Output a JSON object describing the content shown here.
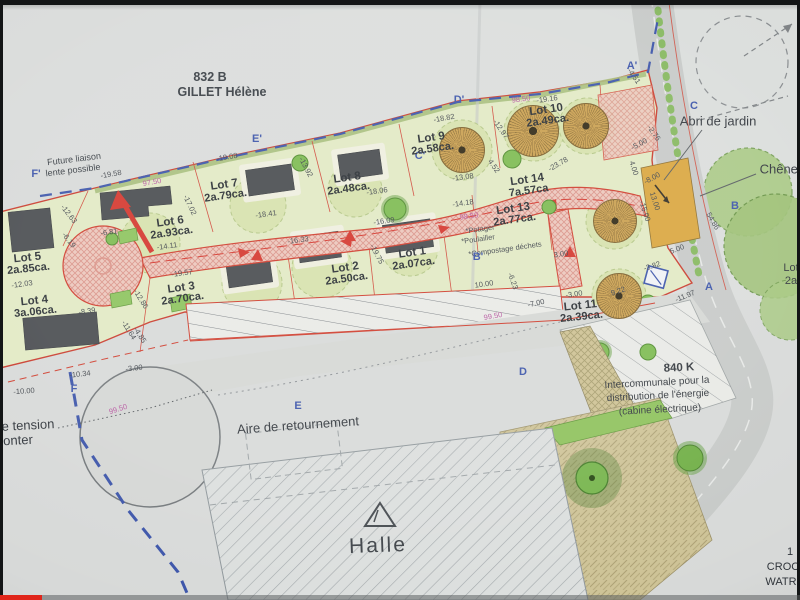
{
  "colors": {
    "accent_red": "#cf3b2b",
    "boundary_blue": "#3952a8",
    "dim_pink": "#b6569f",
    "dim_gray": "#41464c",
    "progress_red": "#e0251a"
  },
  "player": {
    "progress_played_px": 42
  },
  "plan": {
    "lots": [
      {
        "name": "Lot 1",
        "area": "2a.07ca.",
        "x": 413,
        "y": 259,
        "r": -8
      },
      {
        "name": "Lot 2",
        "area": "2a.50ca.",
        "x": 346,
        "y": 274,
        "r": -8
      },
      {
        "name": "Lot 3",
        "area": "2a.70ca.",
        "x": 182,
        "y": 294,
        "r": -8
      },
      {
        "name": "Lot 4",
        "area": "3a.06ca.",
        "x": 35,
        "y": 307,
        "r": -6
      },
      {
        "name": "Lot 5",
        "area": "2a.85ca.",
        "x": 28,
        "y": 264,
        "r": -6
      },
      {
        "name": "Lot 6",
        "area": "2a.93ca.",
        "x": 171,
        "y": 228,
        "r": -8
      },
      {
        "name": "Lot 7",
        "area": "2a.79ca.",
        "x": 225,
        "y": 191,
        "r": -8
      },
      {
        "name": "Lot 8",
        "area": "2a.48ca.",
        "x": 348,
        "y": 184,
        "r": -8
      },
      {
        "name": "Lot 9",
        "area": "2a.58ca.",
        "x": 432,
        "y": 144,
        "r": -8
      },
      {
        "name": "Lot 10",
        "area": "2a.49ca.",
        "x": 547,
        "y": 116,
        "r": -8
      },
      {
        "name": "Lot 11",
        "area": "2a.39ca.",
        "x": 581,
        "y": 312,
        "r": -6
      },
      {
        "name": "Lot 13",
        "area": "2a.77ca.",
        "x": 514,
        "y": 215,
        "r": -8
      },
      {
        "name": "Lot 14",
        "area": "7a.57ca",
        "x": 528,
        "y": 186,
        "r": -8
      }
    ],
    "annotations": [
      {
        "n": "parcel-number",
        "t": "832 B",
        "x": 210,
        "y": 77,
        "s": 12.5,
        "r": 0,
        "c": "#343a40",
        "w": 700
      },
      {
        "n": "parcel-owner",
        "t": "GILLET Hélène",
        "x": 222,
        "y": 92,
        "s": 12.5,
        "r": 0,
        "c": "#343a40",
        "w": 700
      },
      {
        "n": "note-future-liaison-line1",
        "t": "Future liaison",
        "x": 74,
        "y": 159,
        "s": 9,
        "r": -7,
        "c": "#343a40"
      },
      {
        "n": "note-future-liaison-line2",
        "t": "lente possible",
        "x": 73,
        "y": 170,
        "s": 9,
        "r": -7,
        "c": "#343a40"
      },
      {
        "n": "label-abri-de-jardin",
        "t": "Abri de jardin",
        "x": 718,
        "y": 121,
        "s": 13,
        "r": 0,
        "c": "#30353b"
      },
      {
        "n": "label-chenes",
        "t": "Chênes",
        "x": 782,
        "y": 169,
        "s": 13,
        "r": 0,
        "c": "#30353b"
      },
      {
        "n": "label-840k",
        "t": "840 K",
        "x": 679,
        "y": 368,
        "s": 11.5,
        "r": -3,
        "c": "#30353b",
        "w": 700
      },
      {
        "n": "label-intercommunale-line1",
        "t": "Intercommunale pour la",
        "x": 657,
        "y": 383,
        "s": 10,
        "r": -3,
        "c": "#30353b"
      },
      {
        "n": "label-intercommunale-line2",
        "t": "distribution de l'énergie",
        "x": 658,
        "y": 396,
        "s": 10,
        "r": -3,
        "c": "#30353b"
      },
      {
        "n": "label-intercommunale-line3",
        "t": "(cabine électrique)",
        "x": 660,
        "y": 410,
        "s": 10,
        "r": -3,
        "c": "#30353b"
      },
      {
        "n": "label-aire-de-retournement",
        "t": "Aire de retournement",
        "x": 298,
        "y": 425,
        "s": 13,
        "r": -4,
        "c": "#30353b"
      },
      {
        "n": "label-halle",
        "t": "Halle",
        "x": 378,
        "y": 546,
        "s": 21,
        "r": -2,
        "c": "#3a3f44",
        "ls": 2
      },
      {
        "n": "label-tension-fragment",
        "t": "e tension",
        "x": 28,
        "y": 425,
        "s": 13,
        "r": -3,
        "c": "#30353b"
      },
      {
        "n": "label-onter-fragment",
        "t": "onter",
        "x": 18,
        "y": 440,
        "s": 13,
        "r": -3,
        "c": "#30353b"
      },
      {
        "n": "label-number-fragment",
        "t": "1",
        "x": 790,
        "y": 552,
        "s": 11,
        "r": 0,
        "c": "#30353b"
      },
      {
        "n": "label-croc-fragment",
        "t": "CROC",
        "x": 783,
        "y": 567,
        "s": 11,
        "r": 0,
        "c": "#30353b"
      },
      {
        "n": "label-watr-fragment",
        "t": "WATR",
        "x": 781,
        "y": 582,
        "s": 11,
        "r": 0,
        "c": "#30353b"
      },
      {
        "n": "label-lot-fragment",
        "t": "Lot",
        "x": 791,
        "y": 268,
        "s": 11,
        "r": 0,
        "c": "#30353b"
      },
      {
        "n": "label-area-fragment",
        "t": "2a",
        "x": 791,
        "y": 281,
        "s": 11,
        "r": 0,
        "c": "#30353b"
      },
      {
        "n": "lot13-item-potager",
        "t": "*Potager",
        "x": 480,
        "y": 229,
        "s": 7.5,
        "r": -8
      },
      {
        "n": "lot13-item-poulailler",
        "t": "*Poulailler",
        "x": 478,
        "y": 239,
        "s": 7.5,
        "r": -8
      },
      {
        "n": "lot13-item-compostage",
        "t": "*Compostage déchets",
        "x": 505,
        "y": 249,
        "s": 7.5,
        "r": -8
      },
      {
        "n": "section-point",
        "t": "F'",
        "x": 36,
        "y": 174,
        "s": 11,
        "r": 0,
        "c": "#3952a8",
        "w": 700
      },
      {
        "n": "section-point",
        "t": "E'",
        "x": 257,
        "y": 139,
        "s": 11,
        "r": 0,
        "c": "#3952a8",
        "w": 700
      },
      {
        "n": "section-point",
        "t": "D'",
        "x": 459,
        "y": 100,
        "s": 11,
        "r": 0,
        "c": "#3952a8",
        "w": 700
      },
      {
        "n": "section-point",
        "t": "C'",
        "x": 420,
        "y": 156,
        "s": 11,
        "r": 0,
        "c": "#3952a8",
        "w": 700
      },
      {
        "n": "section-point",
        "t": "A'",
        "x": 632,
        "y": 66,
        "s": 11,
        "r": 0,
        "c": "#3952a8",
        "w": 700
      },
      {
        "n": "section-point",
        "t": "C",
        "x": 694,
        "y": 106,
        "s": 11,
        "r": 0,
        "c": "#3952a8",
        "w": 700
      },
      {
        "n": "section-point",
        "t": "B",
        "x": 735,
        "y": 206,
        "s": 11,
        "r": 0,
        "c": "#3952a8",
        "w": 700
      },
      {
        "n": "section-point",
        "t": "A",
        "x": 709,
        "y": 287,
        "s": 11,
        "r": 0,
        "c": "#3952a8",
        "w": 700
      },
      {
        "n": "section-point",
        "t": "B'",
        "x": 478,
        "y": 257,
        "s": 11,
        "r": 0,
        "c": "#3952a8",
        "w": 700
      },
      {
        "n": "section-point",
        "t": "F",
        "x": 74,
        "y": 389,
        "s": 11,
        "r": 0,
        "c": "#3952a8",
        "w": 700
      },
      {
        "n": "section-point",
        "t": "D",
        "x": 523,
        "y": 372,
        "s": 11,
        "r": 0,
        "c": "#3952a8",
        "w": 700
      },
      {
        "n": "section-point",
        "t": "E",
        "x": 298,
        "y": 406,
        "s": 11,
        "r": 0,
        "c": "#3952a8",
        "w": 700
      },
      {
        "n": "dimension",
        "t": "-19.58",
        "x": 111,
        "y": 174,
        "r": -10
      },
      {
        "n": "dimension",
        "t": "97.50",
        "x": 152,
        "y": 182,
        "r": -10,
        "c": "#b6569f"
      },
      {
        "n": "dimension",
        "t": "-19.08",
        "x": 227,
        "y": 157,
        "r": -10
      },
      {
        "n": "dimension",
        "t": "-18.41",
        "x": 266,
        "y": 214
      },
      {
        "n": "dimension",
        "t": "-18.06",
        "x": 377,
        "y": 191
      },
      {
        "n": "dimension",
        "t": "-16.33",
        "x": 298,
        "y": 240
      },
      {
        "n": "dimension",
        "t": "-16.09",
        "x": 384,
        "y": 221
      },
      {
        "n": "dimension",
        "t": "-19.75",
        "x": 377,
        "y": 254,
        "r": 62
      },
      {
        "n": "dimension",
        "t": "-13.92",
        "x": 306,
        "y": 167,
        "r": 62
      },
      {
        "n": "dimension",
        "t": "-17.02",
        "x": 190,
        "y": 205,
        "r": 65
      },
      {
        "n": "dimension",
        "t": "-19.57",
        "x": 182,
        "y": 273
      },
      {
        "n": "dimension",
        "t": "-14.11",
        "x": 167,
        "y": 246
      },
      {
        "n": "dimension",
        "t": "-12.03",
        "x": 22,
        "y": 284
      },
      {
        "n": "dimension",
        "t": "-6.81",
        "x": 109,
        "y": 232
      },
      {
        "n": "dimension",
        "t": "-6.19",
        "x": 69,
        "y": 240,
        "r": 52
      },
      {
        "n": "dimension",
        "t": "-12.63",
        "x": 69,
        "y": 214,
        "r": 52
      },
      {
        "n": "dimension",
        "t": "-8.39",
        "x": 87,
        "y": 311
      },
      {
        "n": "dimension",
        "t": "-12.86",
        "x": 141,
        "y": 299,
        "r": 58
      },
      {
        "n": "dimension",
        "t": "-11.64",
        "x": 129,
        "y": 330,
        "r": 58
      },
      {
        "n": "dimension",
        "t": "-4.85",
        "x": 140,
        "y": 335,
        "r": 58
      },
      {
        "n": "dimension",
        "t": "-13.08",
        "x": 463,
        "y": 177
      },
      {
        "n": "dimension",
        "t": "-18.82",
        "x": 444,
        "y": 118,
        "r": -10
      },
      {
        "n": "dimension",
        "t": "98.50",
        "x": 521,
        "y": 99,
        "c": "#b6569f"
      },
      {
        "n": "dimension",
        "t": "-19.16",
        "x": 547,
        "y": 99
      },
      {
        "n": "dimension",
        "t": "-12.97",
        "x": 501,
        "y": 129,
        "r": 55
      },
      {
        "n": "dimension",
        "t": "4.52",
        "x": 494,
        "y": 166,
        "r": 55
      },
      {
        "n": "dimension",
        "t": "-23.78",
        "x": 558,
        "y": 164,
        "r": -30
      },
      {
        "n": "dimension",
        "t": "98.50",
        "x": 469,
        "y": 216,
        "c": "#b6569f"
      },
      {
        "n": "dimension",
        "t": "-14.18",
        "x": 463,
        "y": 203
      },
      {
        "n": "dimension",
        "t": "3.00",
        "x": 561,
        "y": 254
      },
      {
        "n": "dimension",
        "t": "10.00",
        "x": 484,
        "y": 284
      },
      {
        "n": "dimension",
        "t": "-6.23",
        "x": 513,
        "y": 281,
        "r": 70
      },
      {
        "n": "dimension",
        "t": "-3.00",
        "x": 574,
        "y": 294
      },
      {
        "n": "dimension",
        "t": "-7.00",
        "x": 536,
        "y": 303,
        "r": -12
      },
      {
        "n": "dimension",
        "t": "9.22",
        "x": 618,
        "y": 291,
        "r": -18
      },
      {
        "n": "dimension",
        "t": "99.50",
        "x": 493,
        "y": 316,
        "r": -10,
        "c": "#b6569f"
      },
      {
        "n": "dimension",
        "t": "99.50",
        "x": 118,
        "y": 409,
        "r": -18,
        "c": "#b6569f"
      },
      {
        "n": "dimension",
        "t": "-10.00",
        "x": 24,
        "y": 391,
        "r": -4
      },
      {
        "n": "dimension",
        "t": "-10.34",
        "x": 80,
        "y": 374,
        "r": -6
      },
      {
        "n": "dimension",
        "t": "-3.00",
        "x": 134,
        "y": 368,
        "r": -6
      },
      {
        "n": "dimension",
        "t": "-4.51",
        "x": 634,
        "y": 76,
        "r": 55
      },
      {
        "n": "dimension",
        "t": "-2.76",
        "x": 654,
        "y": 133,
        "r": 55
      },
      {
        "n": "dimension",
        "t": "-5.00",
        "x": 639,
        "y": 144,
        "r": -28
      },
      {
        "n": "dimension",
        "t": "4.00",
        "x": 634,
        "y": 168,
        "r": 72
      },
      {
        "n": "dimension",
        "t": "-8.00",
        "x": 652,
        "y": 178,
        "r": -28
      },
      {
        "n": "dimension",
        "t": "13.00",
        "x": 655,
        "y": 201,
        "r": 72
      },
      {
        "n": "dimension",
        "t": "-15.00",
        "x": 645,
        "y": 211,
        "r": 72
      },
      {
        "n": "dimension",
        "t": "54.86",
        "x": 713,
        "y": 221,
        "r": 60
      },
      {
        "n": "dimension",
        "t": "-3.82",
        "x": 652,
        "y": 266,
        "r": -18
      },
      {
        "n": "dimension",
        "t": "5.00",
        "x": 677,
        "y": 249,
        "r": -22
      },
      {
        "n": "dimension",
        "t": "-11.97",
        "x": 685,
        "y": 296,
        "r": -22
      }
    ]
  }
}
